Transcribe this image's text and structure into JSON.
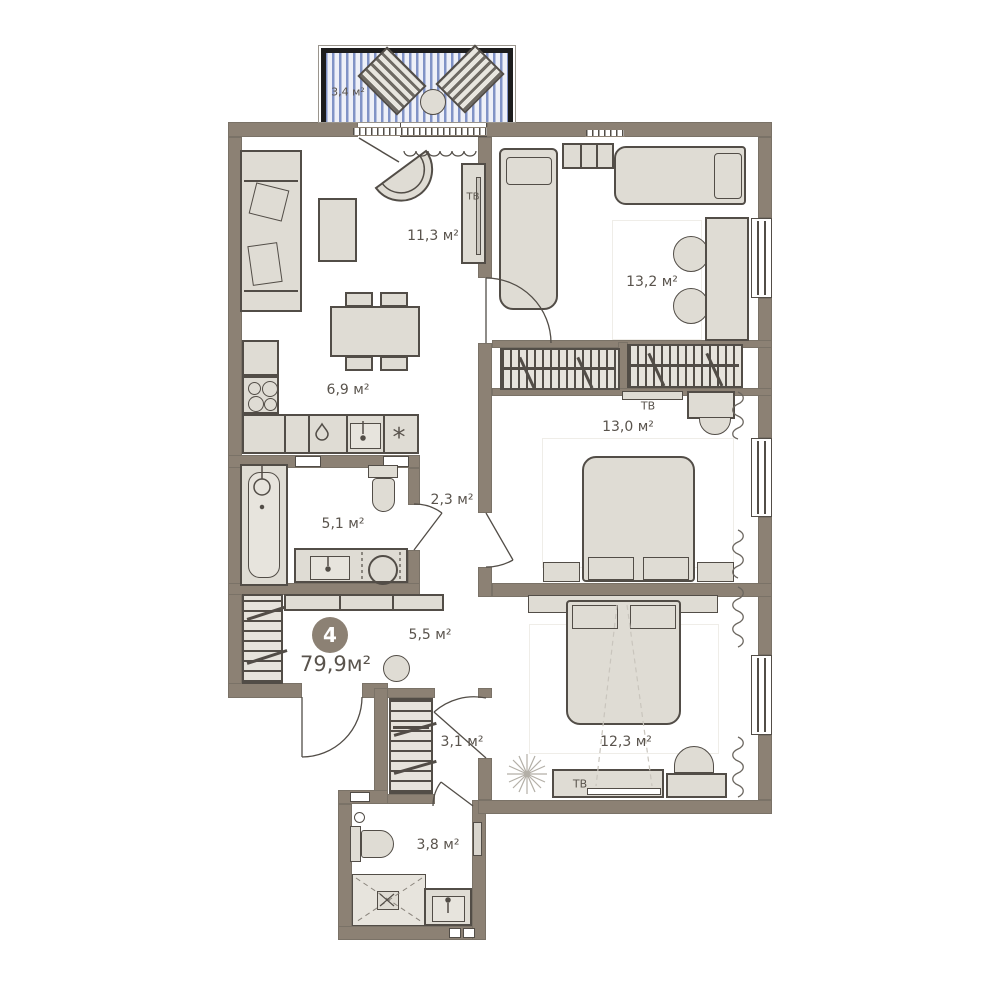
{
  "plan": {
    "badge_number": "4",
    "total_area": "79,9м²",
    "rooms": {
      "balcony": "3,4 м²",
      "living_room": "11,3 м²",
      "kitchen": "6,9 м²",
      "bedroom_top": "13,2 м²",
      "bedroom_middle": "13,0 м²",
      "bedroom_bottom": "12,3 м²",
      "bathroom_main": "5,1 м²",
      "hallway": "2,3 м²",
      "hall": "5,5 м²",
      "corridor": "3,1 м²",
      "bathroom_small": "3,8 м²"
    },
    "tv_labels": {
      "living_room": "ТВ",
      "bedroom_middle": "ТВ",
      "bedroom_bottom": "ТВ"
    },
    "kitchen_symbols": {
      "vent": "*"
    },
    "colors": {
      "wall": "#8c8174",
      "furniture_fill": "#dfdcd4",
      "outline": "#524d47",
      "balcony_stripe": "#8193c6",
      "label_text": "#59534c",
      "badge_background": "#8c8174",
      "badge_text": "#ffffff"
    }
  }
}
